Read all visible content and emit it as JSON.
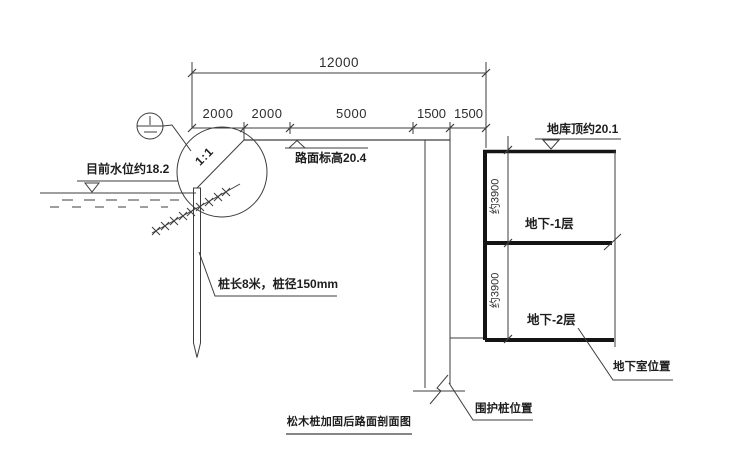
{
  "meta": {
    "title": "松木桩加固后路面剖面图"
  },
  "dimensions": {
    "total_width": "12000",
    "segments": [
      "2000",
      "2000",
      "5000",
      "1500",
      "1500"
    ],
    "basement_floor_heights": [
      "约3900",
      "约3900"
    ]
  },
  "annotations": {
    "current_water_level": "目前水位约18.2",
    "road_elevation": "路面标高20.4",
    "slope_ratio": "1:1",
    "pile_spec": "桩长8米，桩径150mm",
    "garage_roof_elevation": "地库顶约20.1",
    "basement_floor_1": "地下-1层",
    "basement_floor_2": "地下-2层",
    "basement_location": "地下室位置",
    "retaining_pile_location": "围护桩位置"
  },
  "colors": {
    "background": "#ffffff",
    "line": "#3d3d3d",
    "thick_line": "#141414",
    "text": "#1e1e1e"
  }
}
